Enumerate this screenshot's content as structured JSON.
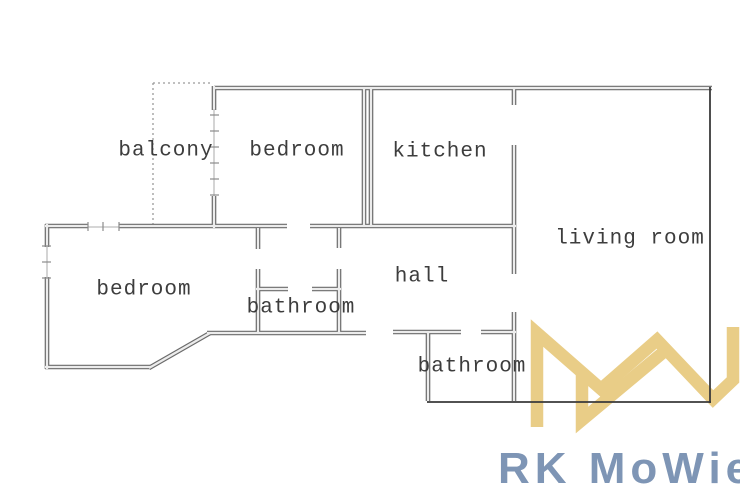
{
  "floorplan": {
    "title": "apartment floor plan",
    "rooms": [
      {
        "id": "balcony",
        "label": "balcony"
      },
      {
        "id": "bedroom-top",
        "label": "bedroom"
      },
      {
        "id": "kitchen",
        "label": "kitchen"
      },
      {
        "id": "living-room",
        "label": "living room"
      },
      {
        "id": "bedroom-left",
        "label": "bedroom"
      },
      {
        "id": "bathroom-center",
        "label": "bathroom"
      },
      {
        "id": "hall",
        "label": "hall"
      },
      {
        "id": "bathroom-bottom",
        "label": "bathroom"
      }
    ],
    "wall_color": "#6b6b6b",
    "wall_fill": "#ececec",
    "thin_wall_color": "#3a3a3a",
    "window_color": "#8b8b8b",
    "balcony_outline_style": "dotted"
  },
  "watermark": {
    "brand_text": "RK MoWie",
    "mark": "MW-monogram",
    "mark_color": "#e9cd87",
    "text_color": "#7e95b5"
  }
}
